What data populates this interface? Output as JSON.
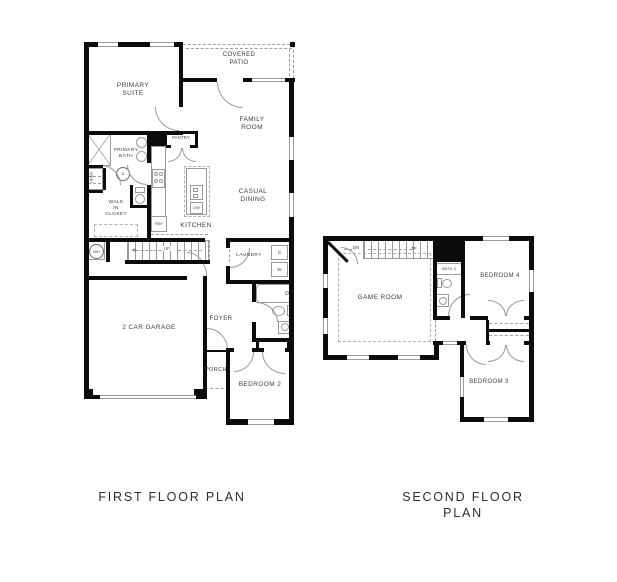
{
  "sheet": {
    "background": "#ffffff",
    "wall_color": "#0c0c0c",
    "line_color": "#9a9a9a",
    "text_color": "#3c3c3c"
  },
  "floor1": {
    "title": "FIRST FLOOR PLAN",
    "rooms": {
      "primary_suite": "PRIMARY\nSUITE",
      "covered_patio": "COVERED\nPATIO",
      "family_room": "FAMILY\nROOM",
      "casual_dining": "CASUAL\nDINING",
      "kitchen": "KITCHEN",
      "pantry": "PANTRY",
      "primary_bath": "PRIMARY\nBATH",
      "linen": "LINEN",
      "walk_in_closet": "WALK\nIN\nCLOSET",
      "laundry": "LAUNDRY",
      "foyer": "FOYER",
      "porch": "PORCH",
      "bedroom_2": "BEDROOM 2",
      "garage": "2 CAR GARAGE"
    },
    "annotations": {
      "stairs": "UP",
      "water_heater": "WH",
      "refrigerator": "REF",
      "dishwasher": "DW",
      "dryer": "D",
      "washer": "W",
      "keynote": "1"
    }
  },
  "floor2": {
    "title": "SECOND FLOOR PLAN",
    "rooms": {
      "game_room": "GAME ROOM",
      "bath_3": "BATH 3",
      "bedroom_4": "BEDROOM 4",
      "bedroom_3": "BEDROOM 3"
    },
    "annotations": {
      "stairs": "DN"
    }
  }
}
